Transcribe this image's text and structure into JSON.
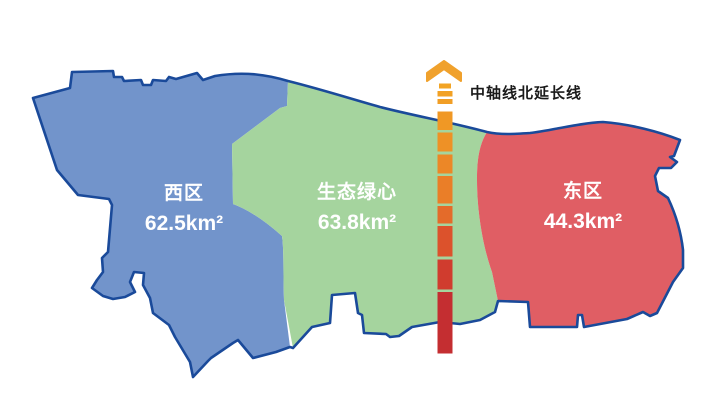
{
  "map": {
    "background": "#FFFFFF",
    "outline_color": "#1A4A9A",
    "label_text_color": "#FFFFFF",
    "regions": [
      {
        "name": "西区",
        "area": "62.5km²",
        "fill": "#7294CB"
      },
      {
        "name": "生态绿心",
        "area": "63.8km²",
        "fill": "#A5D49E"
      },
      {
        "name": "东区",
        "area": "44.3km²",
        "fill": "#E05E64"
      }
    ],
    "axis_line": {
      "label": "中轴线北延长线",
      "label_color": "#1A1A1A",
      "arrow_color": "#F0A12C",
      "gradient_top": "#F2A424",
      "gradient_bottom": "#C42E31"
    }
  }
}
